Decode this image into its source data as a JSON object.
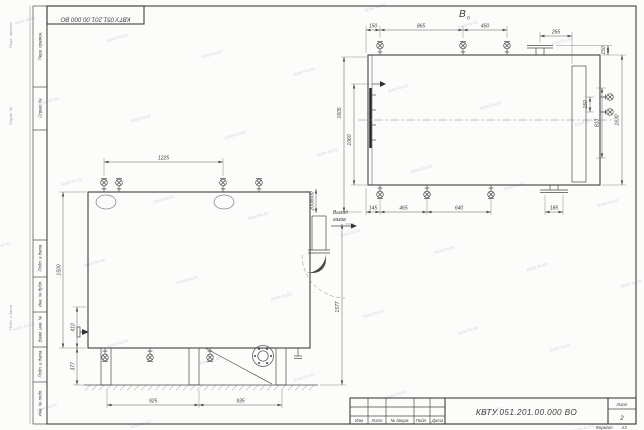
{
  "stamp": {
    "code": "КВТУ.051.201.00.000 ВО"
  },
  "titleblock": {
    "code": "КВТУ.051.201.00.000  ВО",
    "cols": [
      "Изм",
      "Лист",
      "№ докум.",
      "Подп.",
      "Дата"
    ],
    "sheet_label": "Лист",
    "sheet_value": "2",
    "format_label": "Формат",
    "format_value": "А3"
  },
  "margin": {
    "labels": [
      "Перв. примен.",
      "Справ. №",
      "Подп. и дата",
      "Инв. № дубл.",
      "Взам. инв. №",
      "Подп. и дата",
      "Инв. № подл."
    ]
  },
  "views": {
    "front": {
      "dim_top": "1225",
      "dims_left": [
        "1500",
        "410",
        "377"
      ],
      "dims_bottom": [
        "925",
        "935"
      ],
      "dim_right": "1577",
      "dim_duct": "200х600",
      "outlet": [
        "Выход",
        "газов"
      ]
    },
    "top": {
      "label": "В",
      "label_sub": "п",
      "dims_top": [
        "150",
        "865",
        "450",
        "265",
        "150"
      ],
      "dims_right": [
        "150",
        "810",
        "1630"
      ],
      "dims_left": [
        "1605",
        "1060"
      ],
      "dims_bottom": [
        "145",
        "465",
        "640",
        "185"
      ]
    }
  },
  "watermark": "kotel-kv.kz"
}
